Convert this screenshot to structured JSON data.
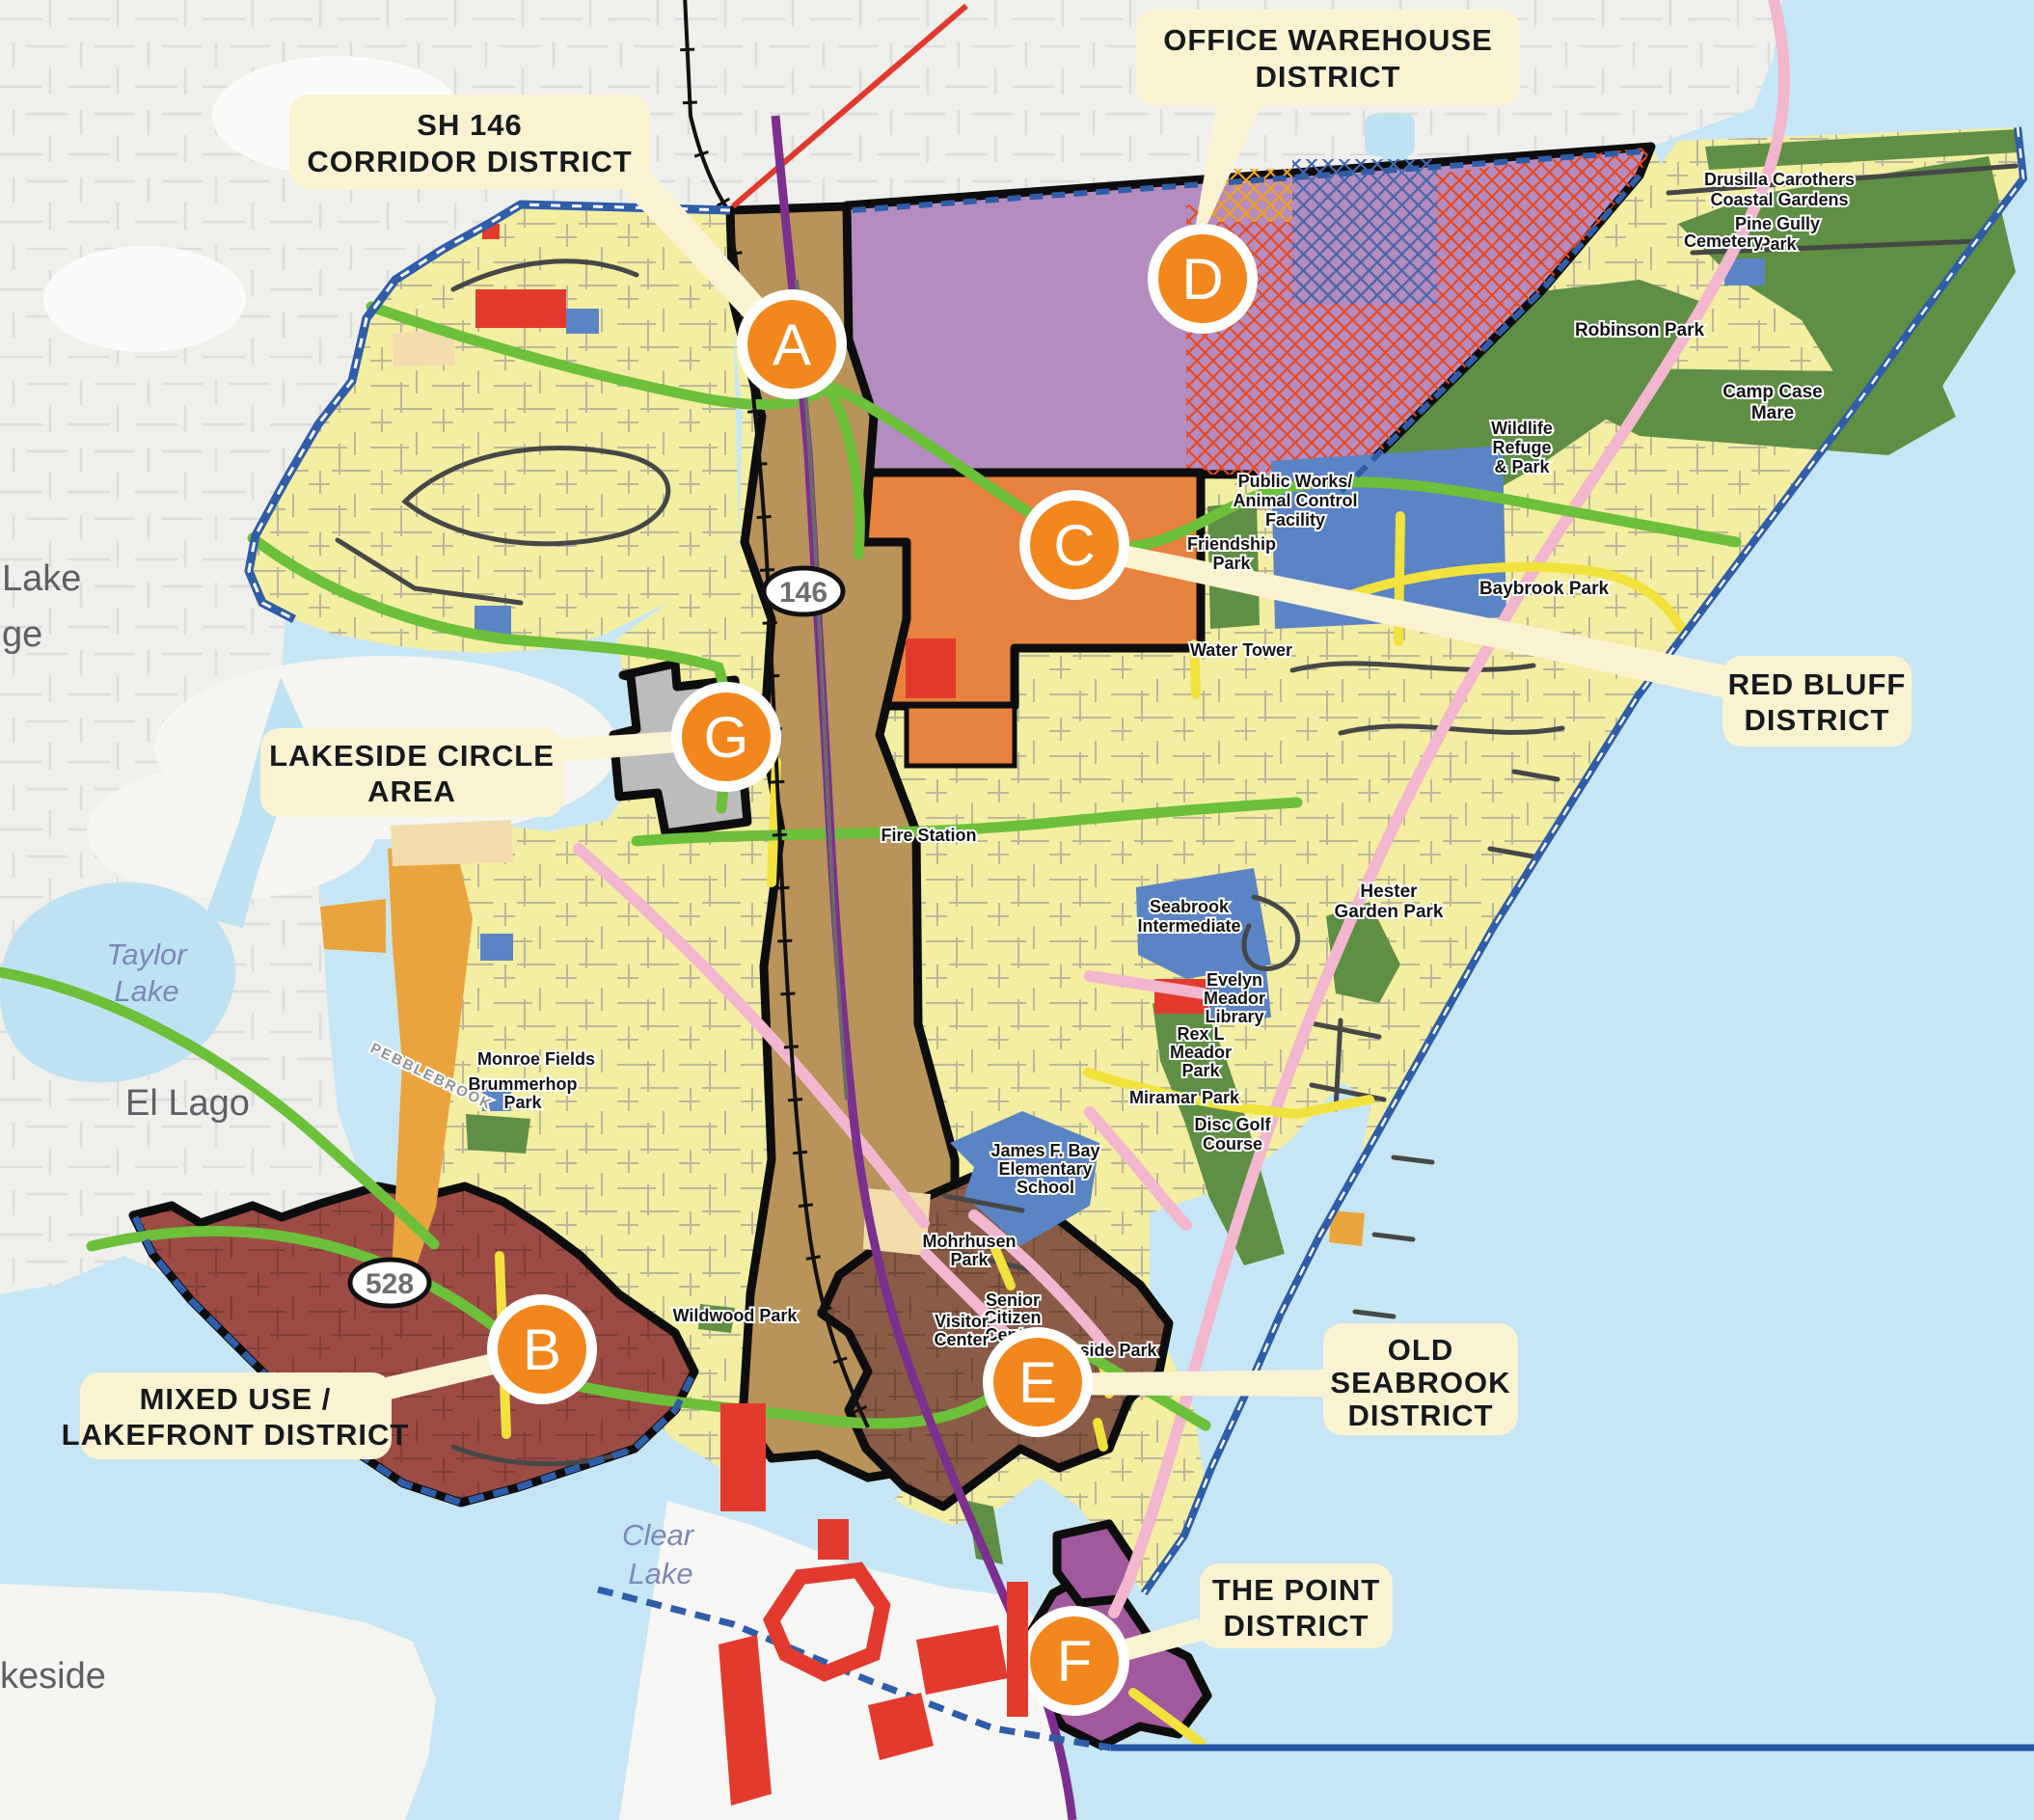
{
  "callouts": {
    "sh146": {
      "line1": "SH 146",
      "line2": "CORRIDOR DISTRICT"
    },
    "office_warehouse": {
      "line1": "OFFICE WAREHOUSE",
      "line2": "DISTRICT"
    },
    "red_bluff": {
      "line1": "RED BLUFF",
      "line2": "DISTRICT"
    },
    "lakeside_circle": {
      "line1": "LAKESIDE CIRCLE",
      "line2": "AREA"
    },
    "mixed_use": {
      "line1": "MIXED USE /",
      "line2": "LAKEFRONT DISTRICT"
    },
    "old_seabrook": {
      "line1": "OLD",
      "line2": "SEABROOK",
      "line3": "DISTRICT"
    },
    "the_point": {
      "line1": "THE POINT",
      "line2": "DISTRICT"
    }
  },
  "markers": {
    "a": "A",
    "b": "B",
    "c": "C",
    "d": "D",
    "e": "E",
    "f": "F",
    "g": "G"
  },
  "shields": {
    "sh146": "146",
    "sh528": "528"
  },
  "water_labels": {
    "taylor_lake": [
      "Taylor",
      "Lake"
    ],
    "clear_lake": [
      "Clear",
      "Lake"
    ]
  },
  "basemap_labels": {
    "taylor_lake_village_partial": [
      "Lake",
      "ge"
    ],
    "el_lago": "El Lago",
    "lakeside_partial": "keside",
    "pebblebrook": "PEBBLEBROOK"
  },
  "poi": {
    "drusilla": [
      "Drusilla Carothers",
      "Coastal Gardens"
    ],
    "pine_gully": [
      "Pine Gully",
      "Park"
    ],
    "cemetery": [
      "Cemetery"
    ],
    "robinson": [
      "Robinson Park"
    ],
    "camp_case": [
      "Camp Case",
      "Mare"
    ],
    "wildlife_refuge": [
      "Wildlife",
      "Refuge",
      "& Park"
    ],
    "public_works": [
      "Public Works/",
      "Animal Control",
      "Facility"
    ],
    "friendship": [
      "Friendship",
      "Park"
    ],
    "water_tower": [
      "Water Tower"
    ],
    "baybrook": [
      "Baybrook Park"
    ],
    "fire_station": [
      "Fire Station"
    ],
    "seabrook_intermediate": [
      "Seabrook",
      "Intermediate"
    ],
    "hester_garden": [
      "Hester",
      "Garden Park"
    ],
    "evelyn_meador": [
      "Evelyn",
      "Meador",
      "Library"
    ],
    "rex_meador": [
      "Rex L",
      "Meador",
      "Park"
    ],
    "miramar": [
      "Miramar Park"
    ],
    "disc_golf": [
      "Disc Golf",
      "Course"
    ],
    "james_bay": [
      "James F. Bay",
      "Elementary",
      "School"
    ],
    "monroe_fields": [
      "Monroe Fields"
    ],
    "brummerhop": [
      "Brummerhop",
      "Park"
    ],
    "mohrhusen": [
      "Mohrhusen",
      "Park"
    ],
    "senior_citizen": [
      "Senior",
      "Citizen",
      "Center"
    ],
    "visitor_center": [
      "Visitor",
      "Center"
    ],
    "bayside": [
      "Bayside Park"
    ],
    "wildwood": [
      "Wildwood Park"
    ]
  },
  "colors": {
    "water": "#c7e6f5",
    "residential_yellow": "#f3eea1",
    "corridor_district": "#b8935a",
    "office_warehouse_district": "#b48cc0",
    "red_bluff_district": "#e8823f",
    "lakeside_circle_area": "#bcbcbc",
    "mixed_use_district": "#9c4c44",
    "old_seabrook_district": "#8a5b46",
    "the_point_district": "#a1589d",
    "park_green": "#5e8f45",
    "public_site_blue": "#5b84c4",
    "marker_orange": "#f2871d",
    "callout_cream": "#faf3d2"
  }
}
